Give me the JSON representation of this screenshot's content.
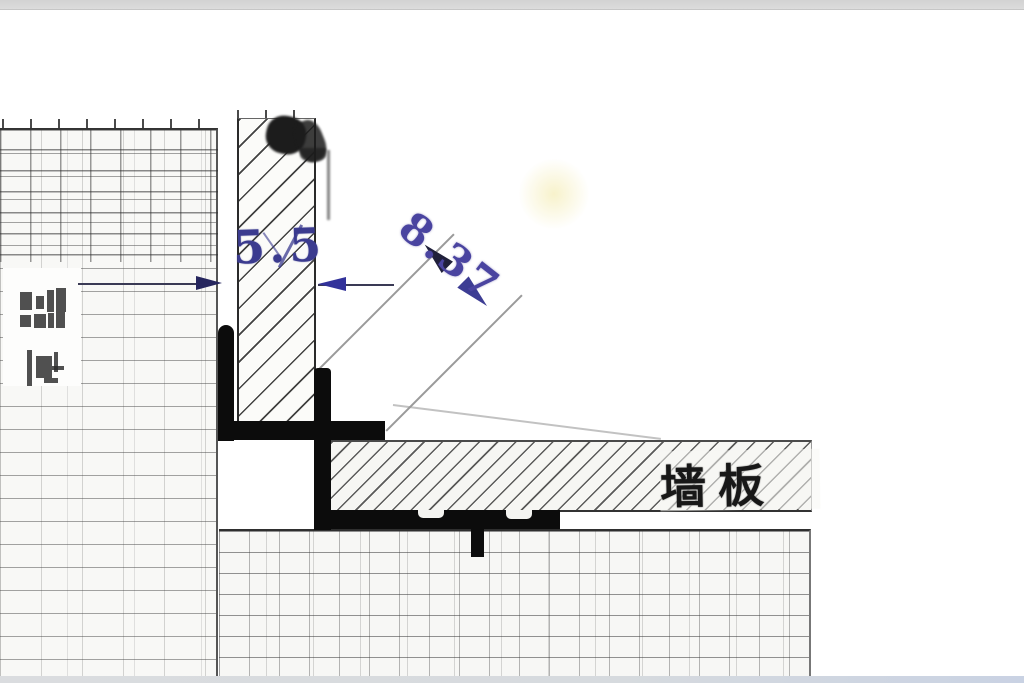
{
  "drawing": {
    "dimensions": [
      {
        "id": "column-width",
        "label": "5.5"
      },
      {
        "id": "profile-diagonal",
        "label": "8.37"
      }
    ],
    "labels": [
      {
        "id": "band-label",
        "text": "墙板"
      }
    ],
    "colors": {
      "ink_blue": "#3b3b8f",
      "ink_violet": "#4a44a0",
      "hatch_line": "#2a2a2a",
      "tile_line": "#6f6f6f",
      "profile_black": "#0c0c0c",
      "top_bar_gray": "#d6d6d6",
      "bottom_band_gray": "#cdd4e2",
      "paper": "#ffffff"
    }
  }
}
